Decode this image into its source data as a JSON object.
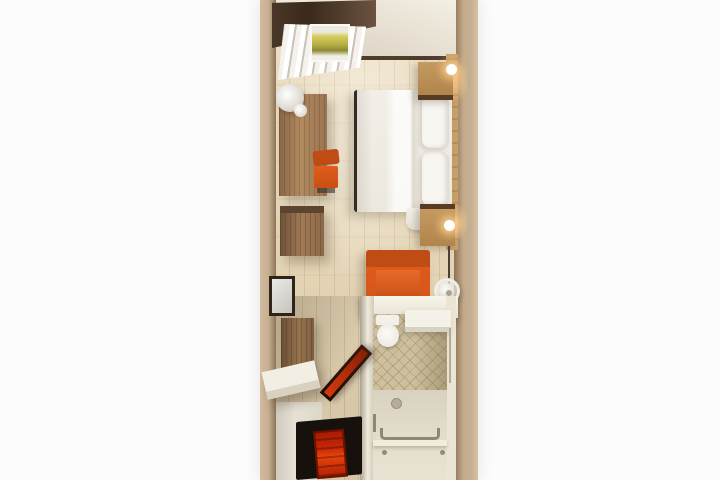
{
  "image": {
    "kind": "3d-top-down-floor-plan-render",
    "description": "Top-down 3D rendering of a narrow hotel guest room: bedroom with double bed, window with vertical blinds, desk area, entry hall with red door mat, and en-suite bathroom with walk-in shower",
    "background": "#fcfcfc"
  },
  "palette": {
    "bg": "#fcfcfc",
    "wall_tan": "#c6ae90",
    "wall_dark": "#4a3727",
    "wall_light": "#ddd5c6",
    "floor_wood": "#e7d8bc",
    "floor_hall": "#ddcfb2",
    "furniture_wood": "#9a7452",
    "nightstand_wood": "#c49a61",
    "bed_white": "#f2efe8",
    "accent_orange": "#e05d1c",
    "accent_orange_dark": "#bf4c15",
    "rug_red": "#c52605",
    "mat_black": "#16110c",
    "tile_beige": "#cec09e",
    "bath_floor": "#d9d2c0",
    "glow_warm": "#ffcf8e",
    "metal_grey": "#8d8777"
  },
  "rooms": {
    "bedroom": [
      "window-with-vertical-blinds",
      "landscape-view",
      "double-bed",
      "pillows",
      "nightstand-top",
      "nightstand-bottom",
      "wall-lamp-top",
      "wall-lamp-bottom",
      "headboard-panel",
      "desk",
      "desk-chair",
      "desk-decor",
      "dresser",
      "armchair",
      "round-side-table"
    ],
    "hall": [
      "wall-mirror",
      "wardrobe",
      "luggage-bench",
      "open-entry-door",
      "black-door-mat",
      "red-rug"
    ],
    "bathroom": [
      "toilet",
      "vanity-shelf",
      "mosaic-tile-wall",
      "walk-in-shower-floor",
      "floor-drain",
      "grab-bar",
      "shower-curb",
      "towel-rail"
    ]
  }
}
